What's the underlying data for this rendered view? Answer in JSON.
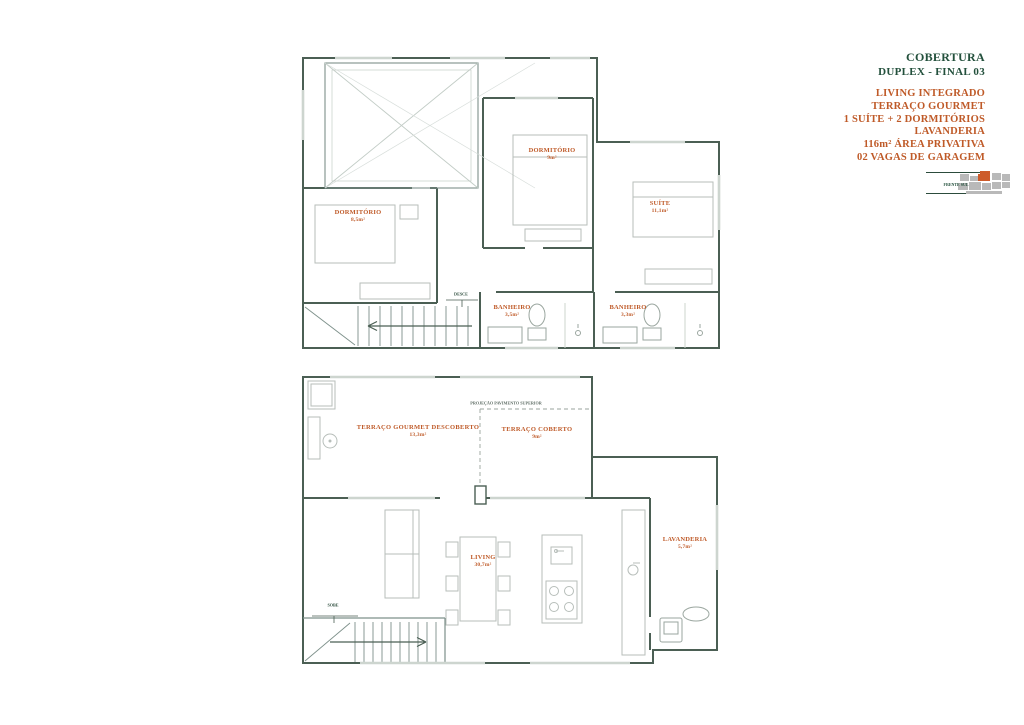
{
  "info_panel": {
    "title": "COBERTURA",
    "subtitle": "DUPLEX - FINAL 03",
    "features": [
      "LIVING INTEGRADO",
      "TERRAÇO GOURMET",
      "1 SUÍTE + 2 DORMITÓRIOS",
      "LAVANDERIA",
      "116m² ÁREA PRIVATIVA",
      "02 VAGAS DE GARAGEM"
    ],
    "keyplan_caption": "FRENTE SUL",
    "colors": {
      "heading": "#23503c",
      "accent": "#bf5a28",
      "wall": "#4b5f54"
    }
  },
  "upper_floor": {
    "rooms": [
      {
        "name": "DORMITÓRIO",
        "area": "8,5m²"
      },
      {
        "name": "DORMITÓRIO",
        "area": "9m²"
      },
      {
        "name": "SUÍTE",
        "area": "11,1m²"
      },
      {
        "name": "BANHEIRO",
        "area": "3,5m²"
      },
      {
        "name": "BANHEIRO",
        "area": "3,3m²"
      }
    ],
    "stair_label": "DESCE"
  },
  "lower_floor": {
    "rooms": [
      {
        "name": "TERRAÇO GOURMET DESCOBERTO",
        "area": "13,3m²"
      },
      {
        "name": "TERRAÇO COBERTO",
        "area": "9m²"
      },
      {
        "name": "LIVING",
        "area": "30,7m²"
      },
      {
        "name": "LAVANDERIA",
        "area": "5,7m²"
      }
    ],
    "stair_label": "SOBE",
    "projection_label": "PROJEÇÃO PAVIMENTO SUPERIOR"
  }
}
